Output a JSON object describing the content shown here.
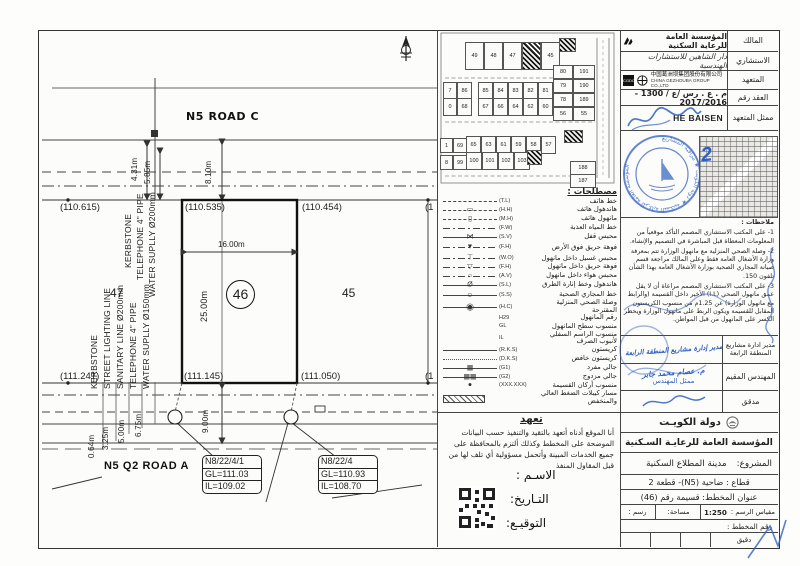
{
  "plan": {
    "road_top": "N5 ROAD C",
    "road_bottom": "N5 Q2 ROAD A",
    "plot_left": "47",
    "plot_center": "46",
    "plot_right": "45",
    "lv_tl": "(110.615)",
    "lv_tc": "(110.535)",
    "lv_tr": "(110.454)",
    "lv_te": "(1",
    "lv_bl": "(111.241)",
    "lv_bc": "(111.145)",
    "lv_br": "(111.050)",
    "lv_be": "(1",
    "dim_width": "16.00m",
    "dim_depth": "25.00m",
    "dim_810": "8.10m",
    "dim_431": "4.31m",
    "dim_585": "5.85m",
    "dim_900": "9.00m",
    "dim_064": "0.64m",
    "dim_325": "3.25m",
    "dim_500": "5.00m",
    "dim_675": "6.75m",
    "ut_t1": "KERBSTONE",
    "ut_t2": "TELEPHONE 4\" PIPE",
    "ut_t3": "WATER SUPLLY Ø200mm",
    "ut_b1": "KERBSTONE",
    "ut_b2": "STREET LIGHTING LINE",
    "ut_b3": "SANITARY LINE Ø200mm",
    "ut_b4": "TELEPHONE 4\" PIPE",
    "ut_b5": "WATER SUPLLY Ø150mm",
    "mh1": {
      "id": "N8/22/4/1",
      "gl": "GL=111.03",
      "il": "IL=109.02"
    },
    "mh2": {
      "id": "N8/22/4",
      "gl": "GL=110.93",
      "il": "IL=108.70"
    }
  },
  "keyplan": {
    "top": [
      "49",
      "48",
      "47",
      "46",
      "45"
    ],
    "rowA": [
      "7",
      "86",
      "85",
      "84",
      "83",
      "82",
      "81"
    ],
    "rowB": [
      "0",
      "68",
      "67",
      "66",
      "64",
      "62",
      "60"
    ],
    "right": [
      "80",
      "191",
      "79",
      "190",
      "78",
      "189",
      "56",
      "55"
    ],
    "midC": [
      "65",
      "63",
      "61",
      "59",
      "58",
      "57"
    ],
    "midD": [
      "100",
      "101",
      "102",
      "103"
    ],
    "leftA": [
      "1",
      "69"
    ],
    "leftB": [
      "8",
      "99"
    ],
    "c394": "394",
    "c188": "188",
    "c187": "187"
  },
  "legend": {
    "title": "مصطلحات :",
    "rows": [
      {
        "code": "(T.L)",
        "label": "خط هاتف"
      },
      {
        "code": "(H.H)",
        "label": "هاندهول هاتف",
        "glyph": "▭"
      },
      {
        "code": "(M.H)",
        "label": "مانهول هاتف",
        "glyph": "▯"
      },
      {
        "code": "(F.W)",
        "label": "خط المياه العذبة"
      },
      {
        "code": "(S.V)",
        "label": "محبس قفل",
        "glyph": "⋈"
      },
      {
        "code": "(F.H)",
        "label": "فوهة حريق فوق الأرض",
        "glyph": "▼"
      },
      {
        "code": "(W.O)",
        "label": "محبس غسيل داخل مانهول",
        "glyph": "⊤"
      },
      {
        "code": "(F.H)",
        "label": "فوهة حريق داخل مانهول",
        "glyph": "▽"
      },
      {
        "code": "(A.V)",
        "label": "محبس هواء داخل مانهول",
        "glyph": "○"
      },
      {
        "code": "(S.L)",
        "label": "هاندهول وخط إنارة الطرق",
        "glyph": "Ø"
      },
      {
        "code": "(S.S)",
        "label": "خط المجاري الصحية",
        "glyph": "○"
      },
      {
        "code": "(H.C)",
        "label": "وصلة الصحي المنزلية المقترحة",
        "glyph": "◉"
      },
      {
        "code": "H29",
        "label": "رقم المانهول"
      },
      {
        "code": "GL",
        "label": "منسوب سطح المانهول"
      },
      {
        "code": "IL",
        "label": "منسوب الراسم السفلي لأنبوب الصرف"
      },
      {
        "code": "(R.K.S)",
        "label": "كريستون"
      },
      {
        "code": "(D.K.S)",
        "label": "كريستون خافض"
      },
      {
        "code": "(G1)",
        "label": "جالي مفرد",
        "glyph": "▦"
      },
      {
        "code": "(G2)",
        "label": "جالي مزدوج",
        "glyph": "▦▦"
      },
      {
        "code": "(XXX.XXX)",
        "label": "منسوب أركان القسيمة",
        "glyph": "●"
      },
      {
        "code": "",
        "label": "مسار كيبلات الضغط العالي والمنخفض"
      }
    ]
  },
  "pledge": {
    "title": "تعهد",
    "body": "أنا الموقع أدناه أتعهد بالتقيد والتنفيذ حسب البيانات الموضحة على المخطط وكذلك ألتزم بالمحافظة على جميع الخدمات المبينة وأتحمل مسؤولية أي تلف لها من قبل المقاول المنفذ",
    "name_label": "الاسـم :",
    "date_label": "التـاريخ:",
    "sign_label": "التوقيـع:"
  },
  "titleblock": {
    "owner_label": "المالك",
    "owner": "المؤسسة العامة للرعاية السكنية",
    "consultant_label": "الاستشاري",
    "consultant": "دار الشاهين للاستشارات الهندسية",
    "contractor_label": "المتعهد",
    "contractor_logo": "CGDC",
    "contractor_cn": "中国葛洲坝集团股份有限公司",
    "contractor_en": "CHINA GEZHOUBA GROUP CO.,LTD",
    "contract_label": "العقد رقم",
    "contract_no": "م . ع . رس /ع / 1300 - 2017/2016",
    "rep_label": "ممثل المتعهد",
    "rep_name": "HE BAISEN",
    "map_mark": "2",
    "notes_title": "ملاحظات :",
    "notes": [
      "1- على المكتب الاستشاري المصمم التأكد موقعياً من المعلومات المعطاة قبل المباشرة في التصميم والإنشاء.",
      "2- وصلة الصحي المنزلية مع مانهول الوزارة تتم بمعرفة وزارة الأشغال العامة فقط وعلى المالك مراجعة قسم صيانة المجاري الصحية بوزارة الأشغال العامة بهذا الشأن تلفون 150.",
      "3- على المكتب الاستشاري المصمم مراعاة أن لا يقل عمق مانهول الصحي (I.L) الأخير داخل القسيمة (والرابط مع مانهول الوزارة) عن 1.25م من منسوب الكريستون المقابل للقسيمة ويكون الربط على مانهول الوزارة ويحظر الكسر على المانهول من قبل المواطن."
    ],
    "sign1_label": "مدير ادارة مشاريع المنطقة الرابعة",
    "sign1_value": "مدير إدارة مشاريع المنطقة الرابعة",
    "sign2_label": "المهندس المقيم",
    "sign2_name": "م. عصام محمد جابر",
    "sign2_role": "ممثل المهندس",
    "sign3_label": "مدقق",
    "country": "دولة الكويـت",
    "authority": "المؤسسة العامة للرعايـة السـكنية",
    "project_label": "المشروع:",
    "project": "مدينة المطلاع السكنية",
    "sector": "قطاع : ضاحية (N5)- قطعة 2",
    "sheet_title": "عنوان المخطط: قسيمة رقم (46)",
    "scale_label": "مقياس الرسم :",
    "scale": "1:250",
    "area_label": "مساحة:",
    "draw_label": "رسم :",
    "plan_no_label": "رقم المخطط :",
    "audit_label": "دقيق"
  }
}
